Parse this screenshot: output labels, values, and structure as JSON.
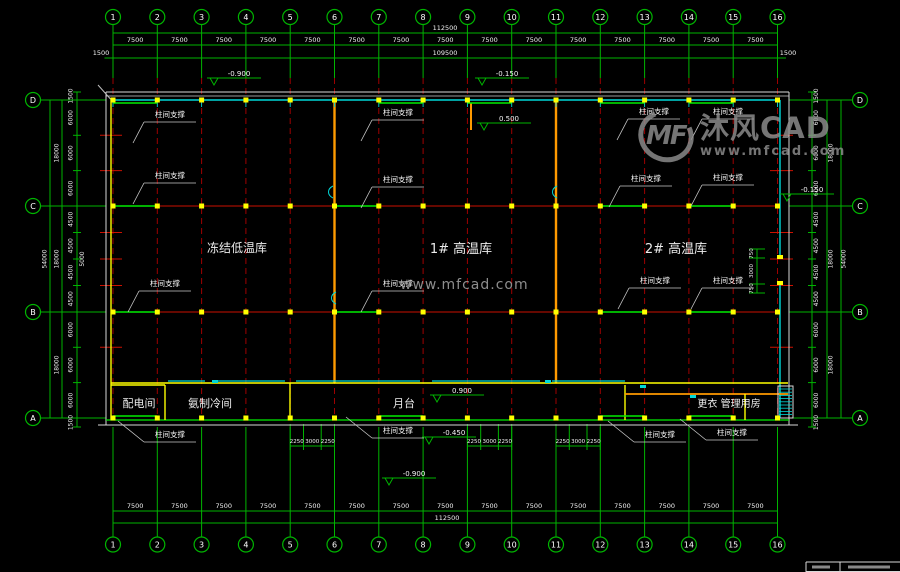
{
  "drawing": {
    "axis_numbers": [
      "1",
      "2",
      "3",
      "4",
      "5",
      "6",
      "7",
      "8",
      "9",
      "10",
      "11",
      "12",
      "13",
      "14",
      "15",
      "16"
    ],
    "axis_letters": [
      "D",
      "C",
      "B",
      "A"
    ],
    "dims": {
      "top_overall": "112500",
      "top_spans": [
        "7500",
        "7500",
        "7500",
        "7500",
        "7500",
        "7500",
        "7500",
        "7500",
        "7500",
        "7500",
        "7500",
        "7500",
        "7500",
        "7500",
        "7500"
      ],
      "top_inner": "109500",
      "top_edge_left": "1500",
      "top_edge_right": "1500",
      "bottom_spans": [
        "7500",
        "7500",
        "7500",
        "7500",
        "7500",
        "7500",
        "7500",
        "7500",
        "7500",
        "7500",
        "7500",
        "7500",
        "7500",
        "7500",
        "7500"
      ],
      "bottom_overall": "112500",
      "side_chain": [
        "1500",
        "6000",
        "6000",
        "6000",
        "4500",
        "4500",
        "4500",
        "4500",
        "6000",
        "6000",
        "6000",
        "1500"
      ],
      "side_groups": [
        "18000",
        "18000",
        "18000"
      ],
      "side_overall": "54000",
      "left_extra": "5000",
      "right_door": [
        "750",
        "3000",
        "750"
      ],
      "platform_door": [
        "2250",
        "3000",
        "2250"
      ]
    },
    "rooms": [
      {
        "name": "冻结低温库",
        "x": 237,
        "y": 252,
        "size": 12
      },
      {
        "name": "1# 高温库",
        "x": 461,
        "y": 253,
        "size": 13
      },
      {
        "name": "2# 高温库",
        "x": 676,
        "y": 253,
        "size": 13
      },
      {
        "name": "配电间",
        "x": 139,
        "y": 407,
        "size": 11
      },
      {
        "name": "氨制冷间",
        "x": 210,
        "y": 407,
        "size": 11
      },
      {
        "name": "月台",
        "x": 404,
        "y": 407,
        "size": 11
      },
      {
        "name": "更衣 管理用房",
        "x": 729,
        "y": 407,
        "size": 10
      }
    ],
    "brace_label": "柱间支撑",
    "brace_positions": [
      [
        170,
        117,
        "d"
      ],
      [
        398,
        115,
        "d"
      ],
      [
        654,
        114,
        "d"
      ],
      [
        728,
        114,
        "d"
      ],
      [
        170,
        178,
        "d"
      ],
      [
        398,
        182,
        "d"
      ],
      [
        646,
        181,
        "d"
      ],
      [
        728,
        180,
        "d"
      ],
      [
        165,
        286,
        "d"
      ],
      [
        398,
        286,
        "d"
      ],
      [
        655,
        283,
        "d"
      ],
      [
        728,
        283,
        "d"
      ],
      [
        170,
        437,
        "u"
      ],
      [
        398,
        433,
        "u"
      ],
      [
        660,
        437,
        "u"
      ],
      [
        732,
        435,
        "u"
      ]
    ],
    "levels": [
      [
        "-0.900",
        237,
        75
      ],
      [
        "-0.150",
        505,
        75
      ],
      [
        "0.500",
        507,
        120
      ],
      [
        "-0.150",
        810,
        191
      ],
      [
        "0.900",
        460,
        392
      ],
      [
        "-0.450",
        452,
        434
      ],
      [
        "-0.900",
        412,
        475
      ]
    ]
  },
  "watermark": {
    "logo_initials": "MF",
    "logo_name": "沐风CAD",
    "logo_site": "www.mfcad.com",
    "center_site": "www.mfcad.com"
  },
  "colors": {
    "grid_green": "#00b400",
    "bright_green": "#00ee00",
    "dim_text": "#f2f2f2",
    "axis_red": "#9e0000",
    "red": "#cc1100",
    "cyan": "#00d8d8",
    "yellow": "#ffff00",
    "orange": "#ff9a00",
    "wall_white": "#d9d9d9",
    "leader_gray": "#c8c8c8",
    "watermark_gray": "#8f8f8f"
  }
}
